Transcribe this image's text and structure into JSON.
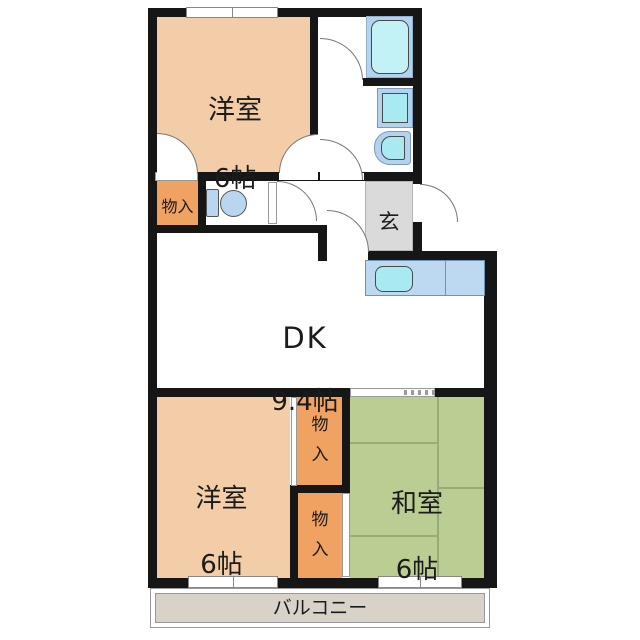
{
  "plan_title": "2DK apartment floor plan",
  "rooms": {
    "western_top": {
      "name": "洋室",
      "size": "6帖"
    },
    "dk": {
      "name": "DK",
      "size": "9.4帖"
    },
    "western_bottom": {
      "name": "洋室",
      "size": "6帖"
    },
    "japanese": {
      "name": "和室",
      "size": "6帖"
    },
    "entrance": {
      "name": "玄"
    },
    "balcony": {
      "name": "バルコニー"
    },
    "closet_hall": {
      "name": "物入"
    },
    "closet_upper": {
      "name": "物入"
    },
    "closet_lower": {
      "name": "物入"
    }
  },
  "fixtures": {
    "bathtub": "bathtub-icon",
    "washing_machine": "washing-machine-icon",
    "washbasin": "washbasin-icon",
    "toilet": "toilet-icon",
    "kitchen_sink": "kitchen-sink-icon"
  },
  "colors": {
    "wall": "#161616",
    "western_room": "#F3CDA7",
    "closet": "#F0A262",
    "tatami": "#BACE94",
    "tatami_line": "#97AC79",
    "entrance_floor": "#DADADA",
    "balcony_floor": "#D9D2C9",
    "fixture_panel": "#B3D2EE",
    "fixture_water": "#A9E9F1"
  }
}
